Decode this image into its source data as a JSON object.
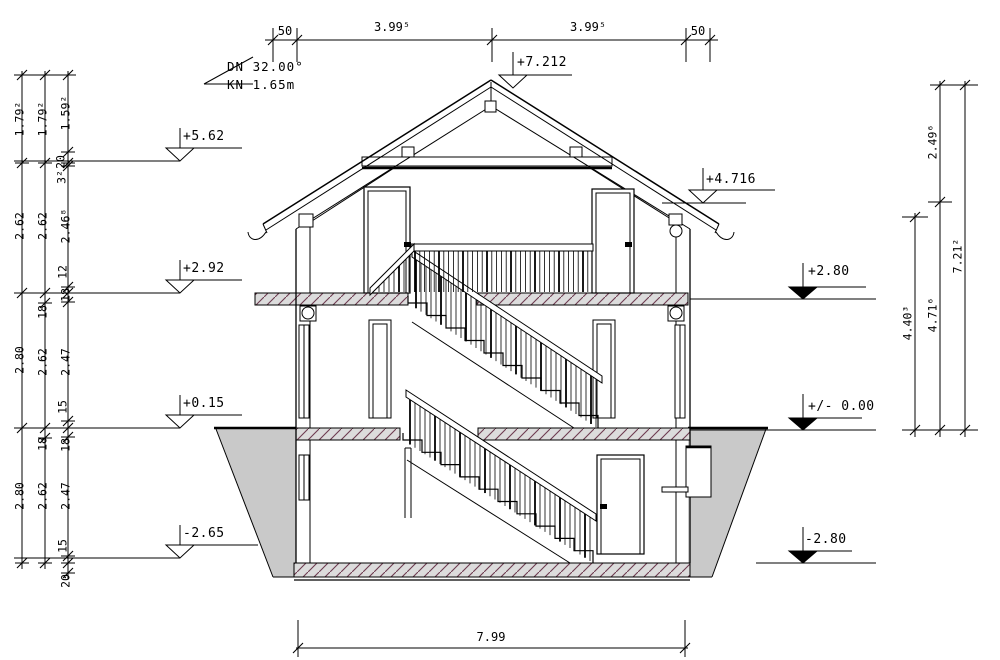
{
  "drawing": {
    "roof_note": {
      "pitch": "DN 32.00°",
      "knee_height": "KN 1.65m"
    },
    "levels": {
      "ridge": "+7.212",
      "eaves_left": "+5.62",
      "upper_floor_left": "+2.92",
      "ground_floor_left": "+0.15",
      "basement_floor_left": "-2.65",
      "eaves_right": "+4.716",
      "upper_slab_right": "+2.80",
      "ground_zero_right": "+/- 0.00",
      "basement_slab_right": "-2.80"
    },
    "dims": {
      "top": [
        "50",
        "3.99⁵",
        "3.99⁵",
        "50"
      ],
      "bottom": "7.99",
      "left_outer": [
        "1.79²",
        "2.62",
        "2.80",
        "2.80"
      ],
      "left_middle": [
        "1.79²",
        "2.62",
        "18",
        "2.62",
        "18",
        "2.62"
      ],
      "left_inner": [
        "1.59²",
        "20",
        "3²",
        "2.46⁸",
        "12",
        "18",
        "2.47",
        "15",
        "18",
        "2.47",
        "15",
        "20"
      ],
      "right_inner": "4.40³",
      "right_middle": [
        "2.49⁶",
        "4.71⁶"
      ],
      "right_outer": "7.21²"
    },
    "colors": {
      "line": "#000000",
      "terrain_fill": "#c9c9c9",
      "slab_fill": "#dcdcdc",
      "slab_hatch": "#6d3b50"
    }
  }
}
